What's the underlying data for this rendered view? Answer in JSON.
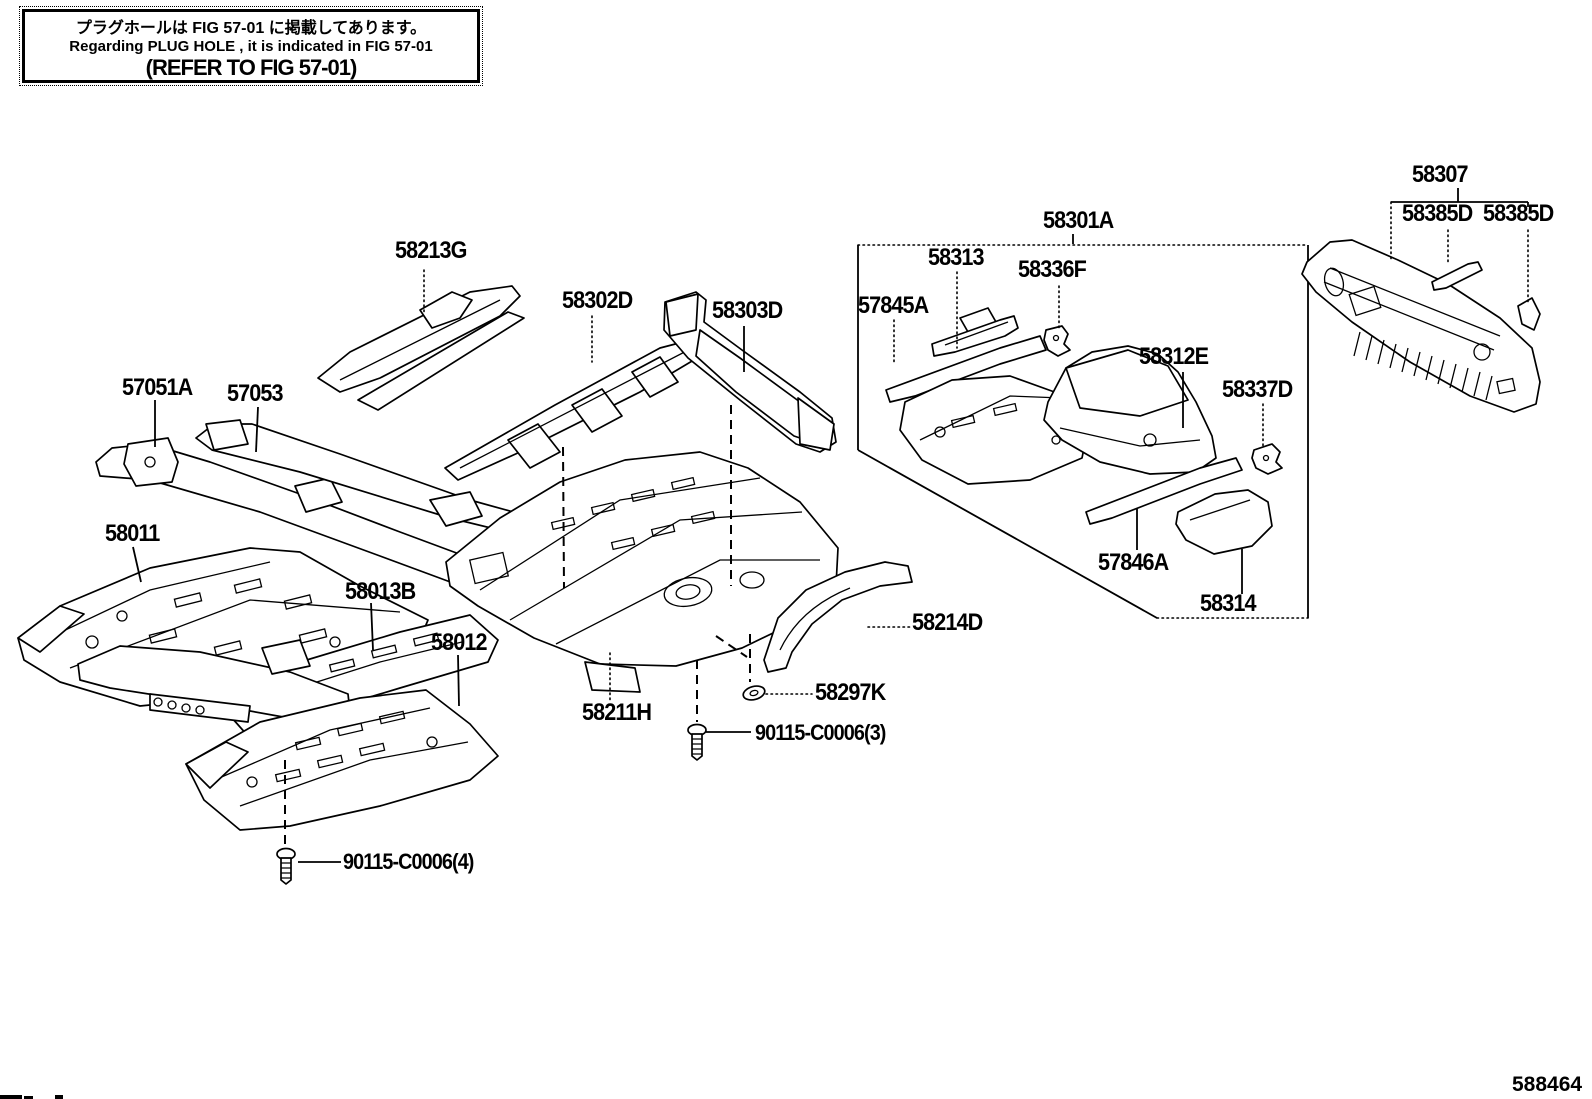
{
  "note_box": {
    "line1": "プラグホールは FIG 57-01 に掲載してあります。",
    "line2": "Regarding  PLUG  HOLE , it is indicated in FIG  57-01",
    "line3": "(REFER  TO  FIG  57-01)"
  },
  "figure": {
    "number": "588464"
  },
  "colors": {
    "ink": "#000000",
    "paper": "#ffffff"
  },
  "labels": {
    "58213G": "58213G",
    "58302D": "58302D",
    "58303D": "58303D",
    "57051A": "57051A",
    "57053": "57053",
    "58011": "58011",
    "58013B": "58013B",
    "58012": "58012",
    "58211H": "58211H",
    "58214D": "58214D",
    "58297K": "58297K",
    "90115_3": "90115-C0006(3)",
    "90115_4": "90115-C0006(4)",
    "58301A": "58301A",
    "58313": "58313",
    "58336F": "58336F",
    "57845A": "57845A",
    "58312E": "58312E",
    "58337D": "58337D",
    "57846A": "57846A",
    "58314": "58314",
    "58307": "58307",
    "58385D_a": "58385D",
    "58385D_b": "58385D"
  }
}
